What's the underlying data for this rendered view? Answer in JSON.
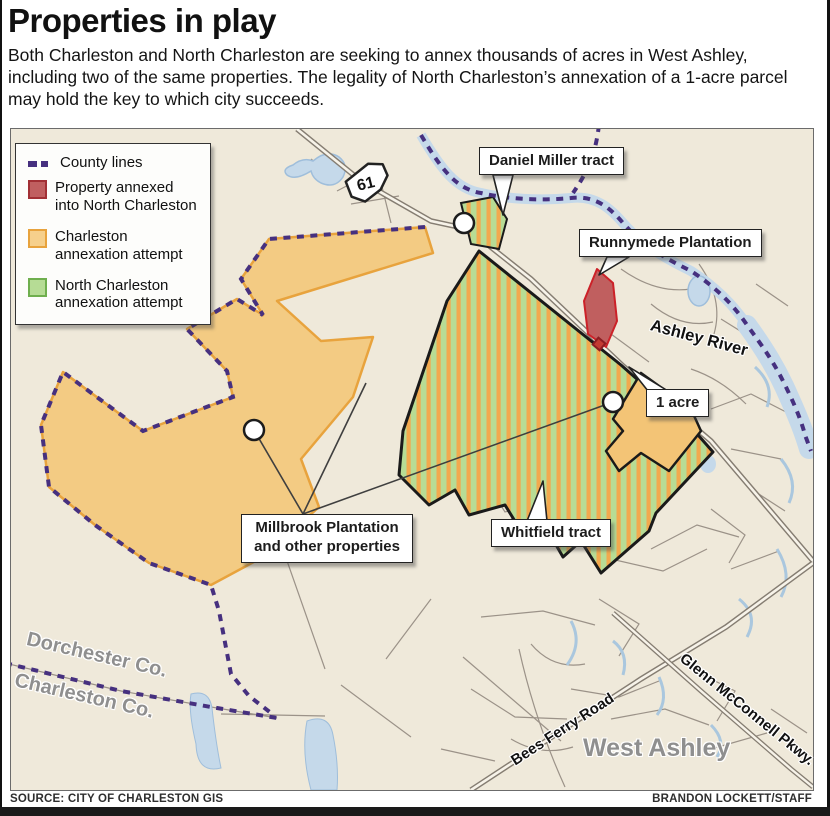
{
  "header": {
    "title": "Properties in play",
    "subtitle": "Both Charleston and North Charleston are seeking to annex thousands of acres in West Ashley, including two of the same properties. The legality of North Charleston’s annexation of a 1-acre parcel may hold the key to which city succeeds."
  },
  "legend": {
    "items": [
      {
        "label": "County lines",
        "symbol": "dashed-line",
        "color": "#46307f"
      },
      {
        "label": "Property annexed into North Charleston",
        "symbol": "square",
        "fill": "#c05f60",
        "border": "#a23035"
      },
      {
        "label": "Charleston annexation attempt",
        "symbol": "square",
        "fill": "#f6d08c",
        "border": "#e8a33d"
      },
      {
        "label": "North Charleston annexation attempt",
        "symbol": "square",
        "fill": "#b6dc95",
        "border": "#6faf4e"
      }
    ]
  },
  "map": {
    "route_shield": "61",
    "callouts": {
      "daniel_miller": "Daniel Miller tract",
      "runnymede": "Runnymede Plantation",
      "one_acre": "1 acre",
      "millbrook": "Millbrook Plantation and other properties",
      "whitfield": "Whitfield tract"
    },
    "labels": {
      "ashley_river": "Ashley River",
      "dorchester": "Dorchester Co.",
      "charleston": "Charleston Co.",
      "bees_ferry": "Bees Ferry Road",
      "glenn_mcconnell": "Glenn McConnell Pkwy.",
      "west_ashley": "West Ashley"
    }
  },
  "footer": {
    "source": "SOURCE: CITY OF CHARLESTON GIS",
    "credit": "BRANDON LOCKETT/STAFF"
  },
  "colors": {
    "map_background": "#efe9da",
    "county_line": "#46307f",
    "annexed_fill": "#c05f60",
    "annexed_border": "#cc2128",
    "charleston_fill": "#f3cb83",
    "charleston_border": "#e8a33d",
    "north_charleston_fill": "#b7dc95",
    "stripe_orange": "#f2a94e",
    "water": "#c5d9ea",
    "major_road": "#857d72",
    "minor_road": "#9b9288"
  }
}
